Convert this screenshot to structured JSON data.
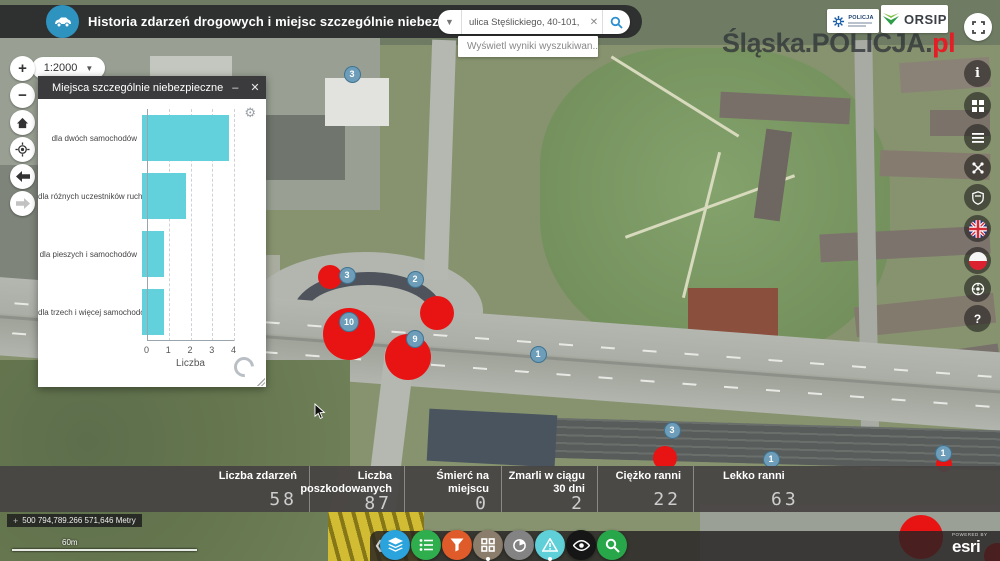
{
  "header": {
    "title": "Historia zdarzeń drogowych i miejsc szczególnie niebezpiecznych",
    "search": {
      "caret_glyph": "▼",
      "value": "ulica Stęślickiego, 40-101, Kat",
      "clear_glyph": "✕",
      "suggestion": "Wyświetl wyniki wyszukiwan..."
    }
  },
  "branding": {
    "policja_label": "POLICJA",
    "orsip_label": "ORSIP",
    "watermark_main": "Śląska.POLICJA.",
    "watermark_accent": "pl"
  },
  "map_controls": {
    "scale_value": "1:2000",
    "scale_caret_glyph": "▼",
    "zoom_in_glyph": "+",
    "zoom_out_glyph": "−"
  },
  "panel": {
    "title": "Miejsca szczególnie niebezpieczne",
    "minimize_glyph": "–",
    "close_glyph": "✕",
    "gear_glyph": "⚙"
  },
  "chart_data": {
    "type": "bar",
    "orientation": "horizontal",
    "title": "Miejsca szczególnie niebezpieczne",
    "categories": [
      "dla dwóch samochodów",
      "dla różnych uczestników ruchu",
      "dla pieszych i samochodów",
      "dla trzech i więcej samochodów"
    ],
    "values": [
      4,
      2,
      1,
      1
    ],
    "xlabel": "Liczba",
    "xlim": [
      0,
      4
    ],
    "xticks": [
      0,
      1,
      2,
      3,
      4
    ],
    "bar_color": "#63d1db",
    "grid": "dashed-vertical"
  },
  "stats_bar": {
    "items": [
      {
        "label": "Liczba zdarzeń",
        "value": "58"
      },
      {
        "label": "Liczba poszkodowanych",
        "value": "87"
      },
      {
        "label": "Śmierć na miejscu",
        "value": "0"
      },
      {
        "label": "Zmarli w ciągu 30 dni",
        "value": "2"
      },
      {
        "label": "Ciężko ranni",
        "value": "22"
      },
      {
        "label": "Lekko ranni",
        "value": "63"
      }
    ]
  },
  "markers": {
    "cluster_color": "#e81414",
    "badge_fill": "#6d9db8",
    "badge_border": "#3f7392",
    "clusters": [
      {
        "x": 330,
        "y": 277,
        "d": 24
      },
      {
        "x": 437,
        "y": 313,
        "d": 34
      },
      {
        "x": 349,
        "y": 334,
        "d": 52
      },
      {
        "x": 408,
        "y": 357,
        "d": 46
      },
      {
        "x": 665,
        "y": 458,
        "d": 24
      },
      {
        "x": 944,
        "y": 464,
        "d": 16
      },
      {
        "x": 921,
        "y": 537,
        "d": 44
      },
      {
        "x": 997,
        "y": 556,
        "d": 26
      }
    ],
    "badges": [
      {
        "label": "3",
        "x": 352,
        "y": 74,
        "d": 17
      },
      {
        "label": "3",
        "x": 347,
        "y": 275,
        "d": 17
      },
      {
        "label": "2",
        "x": 415,
        "y": 279,
        "d": 17
      },
      {
        "label": "10",
        "x": 349,
        "y": 322,
        "d": 20
      },
      {
        "label": "9",
        "x": 415,
        "y": 339,
        "d": 18
      },
      {
        "label": "1",
        "x": 538,
        "y": 354,
        "d": 17
      },
      {
        "label": "3",
        "x": 672,
        "y": 430,
        "d": 17
      },
      {
        "label": "1",
        "x": 771,
        "y": 459,
        "d": 17
      },
      {
        "label": "1",
        "x": 943,
        "y": 453,
        "d": 17
      }
    ]
  },
  "toolbar": {
    "collapse_glyph": "❮",
    "buttons": [
      {
        "icon": "layers-icon",
        "color": "#2ba3dc",
        "active_dot": false
      },
      {
        "icon": "legend-list-icon",
        "color": "#2fae4e",
        "active_dot": false
      },
      {
        "icon": "filter-funnel-icon",
        "color": "#df5b2a",
        "active_dot": false
      },
      {
        "icon": "basemap-grid-icon",
        "color": "#8b7d6b",
        "active_dot": true
      },
      {
        "icon": "pie-chart-icon",
        "color": "#838383",
        "active_dot": false
      },
      {
        "icon": "warning-triangle-icon",
        "color": "#5fd0d8",
        "active_dot": true
      },
      {
        "icon": "eye-icon",
        "color": "#161616",
        "active_dot": false
      },
      {
        "icon": "search-icon",
        "color": "#27a64a",
        "active_dot": false
      }
    ]
  },
  "sidebar": {
    "info_glyph": "i",
    "help_glyph": "?"
  },
  "status_bar": {
    "coordinates": "500 794,789.266 571,646 Metry",
    "crosshair_glyph": "+",
    "scalebar_label": "60m"
  },
  "footer": {
    "powered_by": "POWERED BY",
    "esri_label": "esri"
  }
}
